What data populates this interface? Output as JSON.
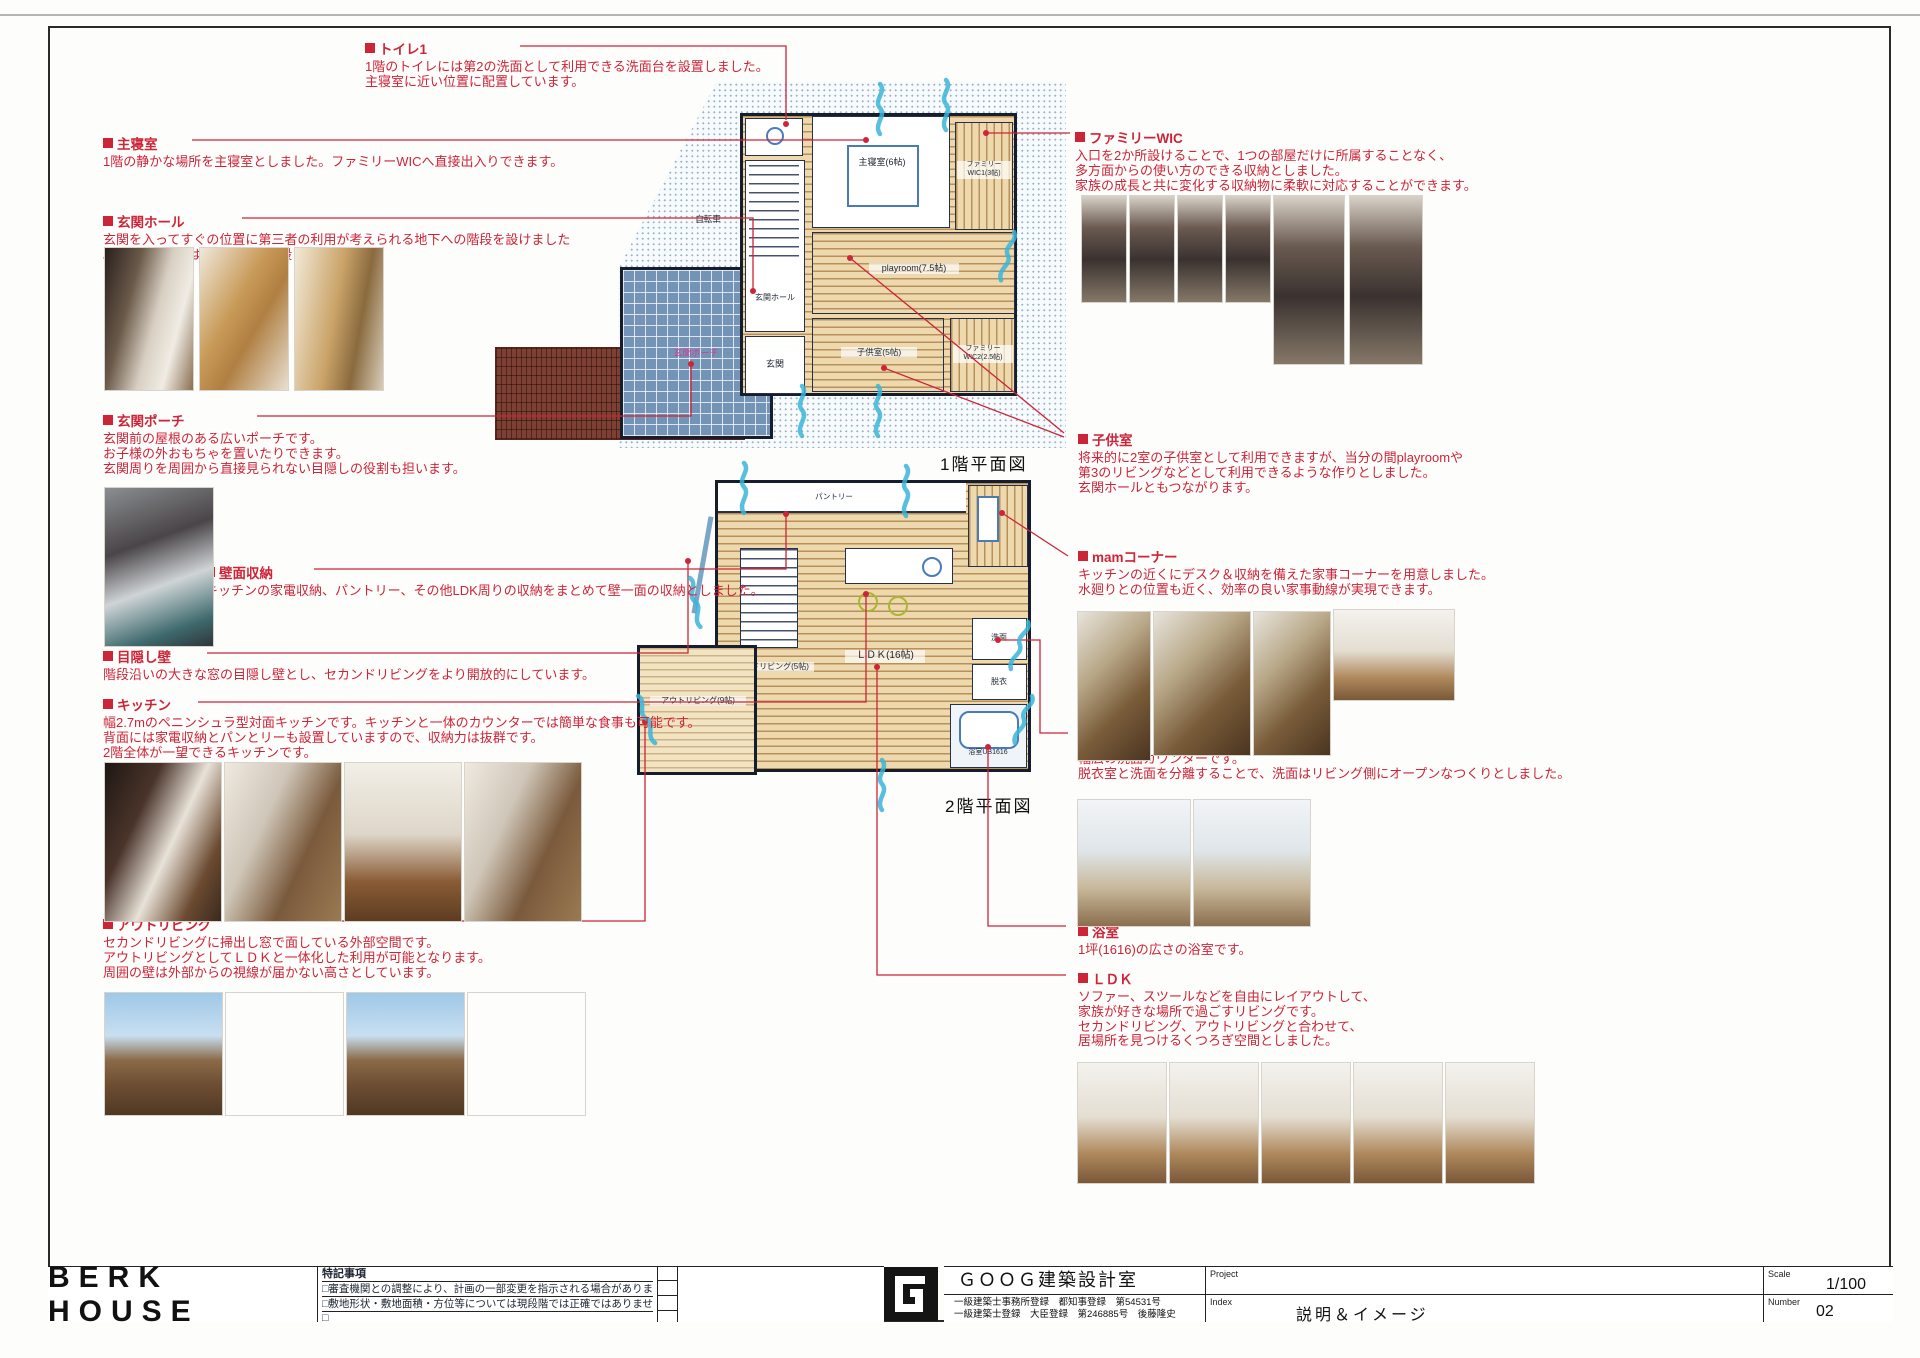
{
  "sheet": {
    "title": "BERK HOUSE",
    "notes_title": "特記事項",
    "notes": [
      "□審査機関との調整により、計画の一部変更を指示される場合があります。",
      "□敷地形状・敷地面積・方位等については現段階では正確ではありません。",
      "□"
    ],
    "firm_name": "ＧＯＯＧ建築設計室",
    "firm_reg1": "一級建築士事務所登録　都知事登録　第54531号",
    "firm_reg2": "一級建築士登録　大臣登録　第246885号　後藤隆史",
    "project_label": "Project",
    "index_label": "Index",
    "index_value": "説明＆イメージ",
    "scale_label": "Scale",
    "scale_value": "1/100",
    "number_label": "Number",
    "number_value": "02"
  },
  "plans": {
    "floor1": {
      "caption": "1階平面図",
      "rooms": {
        "bedroom": "主寝室(6帖)",
        "wic1": "ファミリーWIC1(3帖)",
        "playroom": "playroom(7.5帖)",
        "kids": "子供室(5帖)",
        "wic2": "ファミリーWIC2(2.5帖)",
        "hall": "玄関ホール",
        "entrance": "玄関",
        "porch": "玄関ポーチ",
        "bicycle": "自転車"
      }
    },
    "floor2": {
      "caption": "2階平面図",
      "rooms": {
        "out_living": "アウトリビング(9帖)",
        "second_living": "セカンドリビング(5帖)",
        "ldk": "ＬＤＫ(16帖)",
        "pantry": "パントリー",
        "wash": "洗面",
        "dress": "脱衣",
        "bath": "浴室UB1616"
      }
    }
  },
  "annotations": {
    "toilet": {
      "title": "トイレ1",
      "lines": [
        "1階のトイレには第2の洗面として利用できる洗面台を設置しました。",
        "主寝室に近い位置に配置しています。"
      ]
    },
    "master": {
      "title": "主寝室",
      "lines": [
        "1階の静かな場所を主寝室としました。ファミリーWICへ直接出入りできます。"
      ]
    },
    "hall": {
      "title": "玄関ホール",
      "lines": [
        "玄関を入ってすぐの位置に第三者の利用が考えられる地下への階段を設けました",
        "。2階への階段はスケルトン階段としています。"
      ]
    },
    "porch": {
      "title": "玄関ポーチ",
      "lines": [
        "玄関前の屋根のある広いポーチです。",
        "お子様の外おもちゃを置いたりできます。",
        "玄関周りを周囲から直接見られない目隠しの役割も担います。"
      ]
    },
    "wall_storage": {
      "title": "壁面収納",
      "lines": [
        "キッチンの家電収納、パントリー、その他LDK周りの収納をまとめて壁一面の収納としました。"
      ]
    },
    "blind_wall": {
      "title": "目隠し壁",
      "lines": [
        "階段沿いの大きな窓の目隠し壁とし、セカンドリビングをより開放的にしています。"
      ]
    },
    "kitchen": {
      "title": "キッチン",
      "lines": [
        "幅2.7mのペニンシュラ型対面キッチンです。キッチンと一体のカウンターでは簡単な食事も可能です。",
        "背面には家電収納とパンとリーも設置していますので、収納力は抜群です。",
        "2階全体が一望できるキッチンです。"
      ]
    },
    "out_living": {
      "title": "アウトリビング",
      "lines": [
        "セカンドリビングに掃出し窓で面している外部空間です。",
        "アウトリビングとしてＬＤＫと一体化した利用が可能となります。",
        "周囲の壁は外部からの視線が届かない高さとしています。"
      ]
    },
    "family_wic": {
      "title": "ファミリーWIC",
      "lines": [
        "入口を2か所設けることで、1つの部屋だけに所属することなく、",
        "多方面からの使い方のできる収納としました。",
        "家族の成長と共に変化する収納物に柔軟に対応することができます。"
      ]
    },
    "kids_room": {
      "title": "子供室",
      "lines": [
        "将来的に2室の子供室として利用できますが、当分の間playroomや",
        "第3のリビングなどとして利用できるような作りとしました。",
        "玄関ホールともつながります。"
      ]
    },
    "mam_corner": {
      "title": "mamコーナー",
      "lines": [
        "キッチンの近くにデスク＆収納を備えた家事コーナーを用意しました。",
        "水廻りとの位置も近く、効率の良い家事動線が実現できます。"
      ]
    },
    "washroom": {
      "title": "洗面",
      "lines": [
        "幅広の洗面カウンターです。",
        "脱衣室と洗面を分離することで、洗面はリビング側にオープンなつくりとしました。"
      ]
    },
    "bathroom": {
      "title": "浴室",
      "lines": [
        "1坪(1616)の広さの浴室です。"
      ]
    },
    "ldk": {
      "title": "ＬＤＫ",
      "lines": [
        "ソファー、スツールなどを自由にレイアウトして、",
        "家族が好きな場所で過ごすリビングです。",
        "セカンドリビング、アウトリビングと合わせて、",
        "居場所を見つけるくつろぎ空間としました。"
      ]
    }
  }
}
